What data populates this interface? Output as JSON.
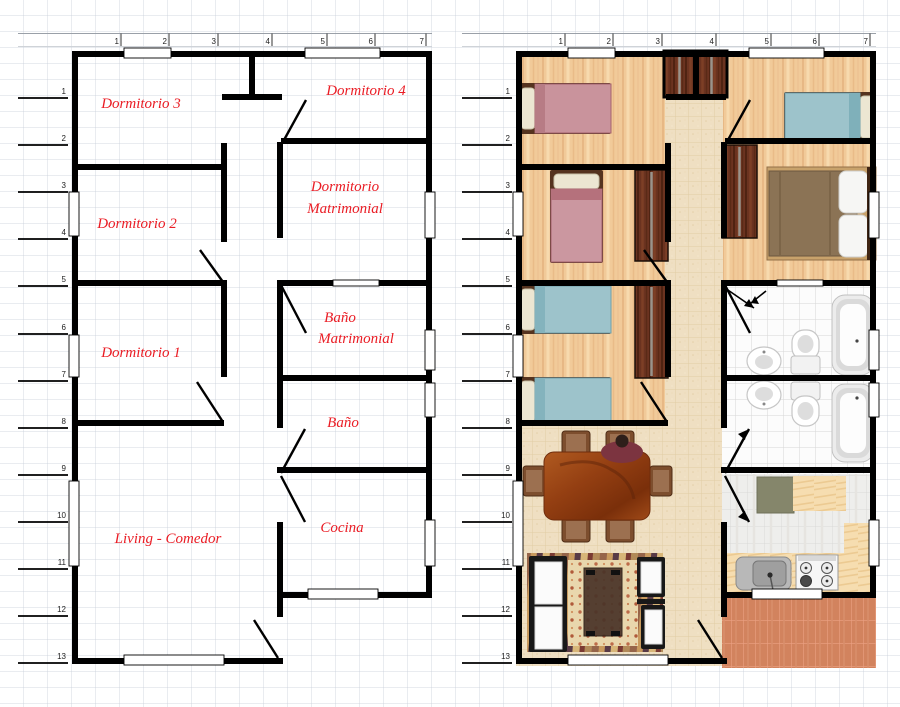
{
  "rulers": {
    "top": [
      "1",
      "2",
      "3",
      "4",
      "5",
      "6",
      "7"
    ],
    "side": [
      "1",
      "2",
      "3",
      "4",
      "5",
      "6",
      "7",
      "8",
      "9",
      "10",
      "11",
      "12",
      "13"
    ]
  },
  "left_plan": {
    "room_labels": [
      {
        "id": "dormitorio-3",
        "lines": [
          "Dormitorio 3"
        ]
      },
      {
        "id": "dormitorio-4",
        "lines": [
          "Dormitorio 4"
        ]
      },
      {
        "id": "dormitorio-2",
        "lines": [
          "Dormitorio 2"
        ]
      },
      {
        "id": "dormitorio-matrimonial",
        "lines": [
          "Dormitorio",
          "Matrimonial"
        ]
      },
      {
        "id": "bano-matrimonial",
        "lines": [
          "Baño",
          "Matrimonial"
        ]
      },
      {
        "id": "dormitorio-1",
        "lines": [
          "Dormitorio 1"
        ]
      },
      {
        "id": "bano",
        "lines": [
          "Baño"
        ]
      },
      {
        "id": "living-comedor",
        "lines": [
          "Living - Comedor"
        ]
      },
      {
        "id": "cocina",
        "lines": [
          "Cocina"
        ]
      }
    ]
  },
  "right_plan": {
    "furniture": [
      "closet",
      "single-bed-pink",
      "single-bed-blue",
      "double-bed",
      "wardrobe",
      "toilet",
      "bidet",
      "bathtub",
      "kitchen-sink",
      "stove",
      "kitchen-counter",
      "kitchen-mat",
      "dining-table",
      "dining-chair",
      "seated-person",
      "sofa",
      "armchair",
      "coffee-table",
      "striped-rug",
      "dotted-runner-rug",
      "patio-tiles"
    ]
  },
  "colors": {
    "wall": "#000000",
    "label_red": "#ea1c24",
    "wood": "#f1ca99",
    "hall_tile": "#efdfc2",
    "bath_tile": "#fcfcfc",
    "kitchen_tile": "#eeeeec",
    "counter": "#f6ddb0",
    "patio": "#d2835e",
    "bed_pink": "#c9939c",
    "bed_blue": "#9dc3cb",
    "bed_brown": "#8b7355",
    "wardrobe": "#6b3320",
    "pillow": "#ece6d2",
    "sofa_frame": "#181818",
    "cushion": "#fbfbfb",
    "table_wood": "#943f12",
    "chair_wood": "#7d4e2e",
    "rug_base": "#b28a58",
    "runner": "#e9d7ad",
    "kitchen_mat": "#85866b"
  }
}
